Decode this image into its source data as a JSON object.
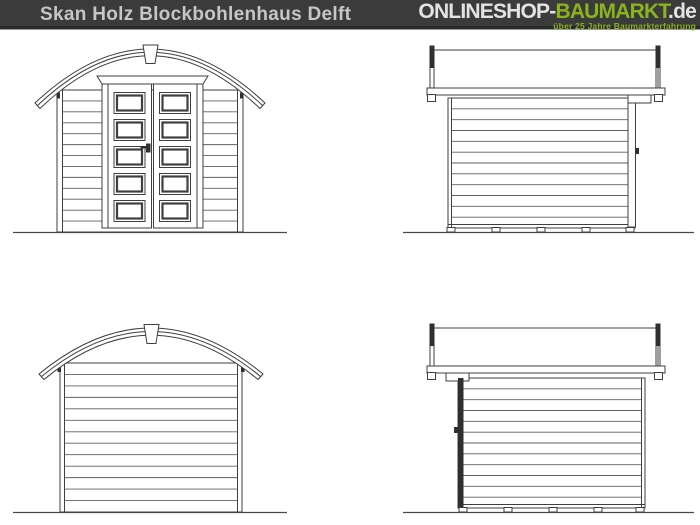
{
  "header": {
    "title": "Skan Holz Blockbohlenhaus Delft",
    "logo": {
      "name1": "ONLINESHOP-",
      "name2": "BAUMARKT",
      "name3": ".de",
      "tagline": "über 25 Jahre Baumarkterfahrung"
    }
  },
  "colors": {
    "header_background": "#3b3b3b",
    "title_text": "#c6c6c6",
    "logo_text": "#e3e3e3",
    "brand_green": "#8ab41d",
    "drawing_line": "#3f3f3f",
    "canvas_background": "#ffffff"
  },
  "drawing": {
    "views": [
      {
        "name": "front-elevation"
      },
      {
        "name": "side-elevation-door-right"
      },
      {
        "name": "rear-elevation"
      },
      {
        "name": "side-elevation-door-left"
      }
    ]
  }
}
